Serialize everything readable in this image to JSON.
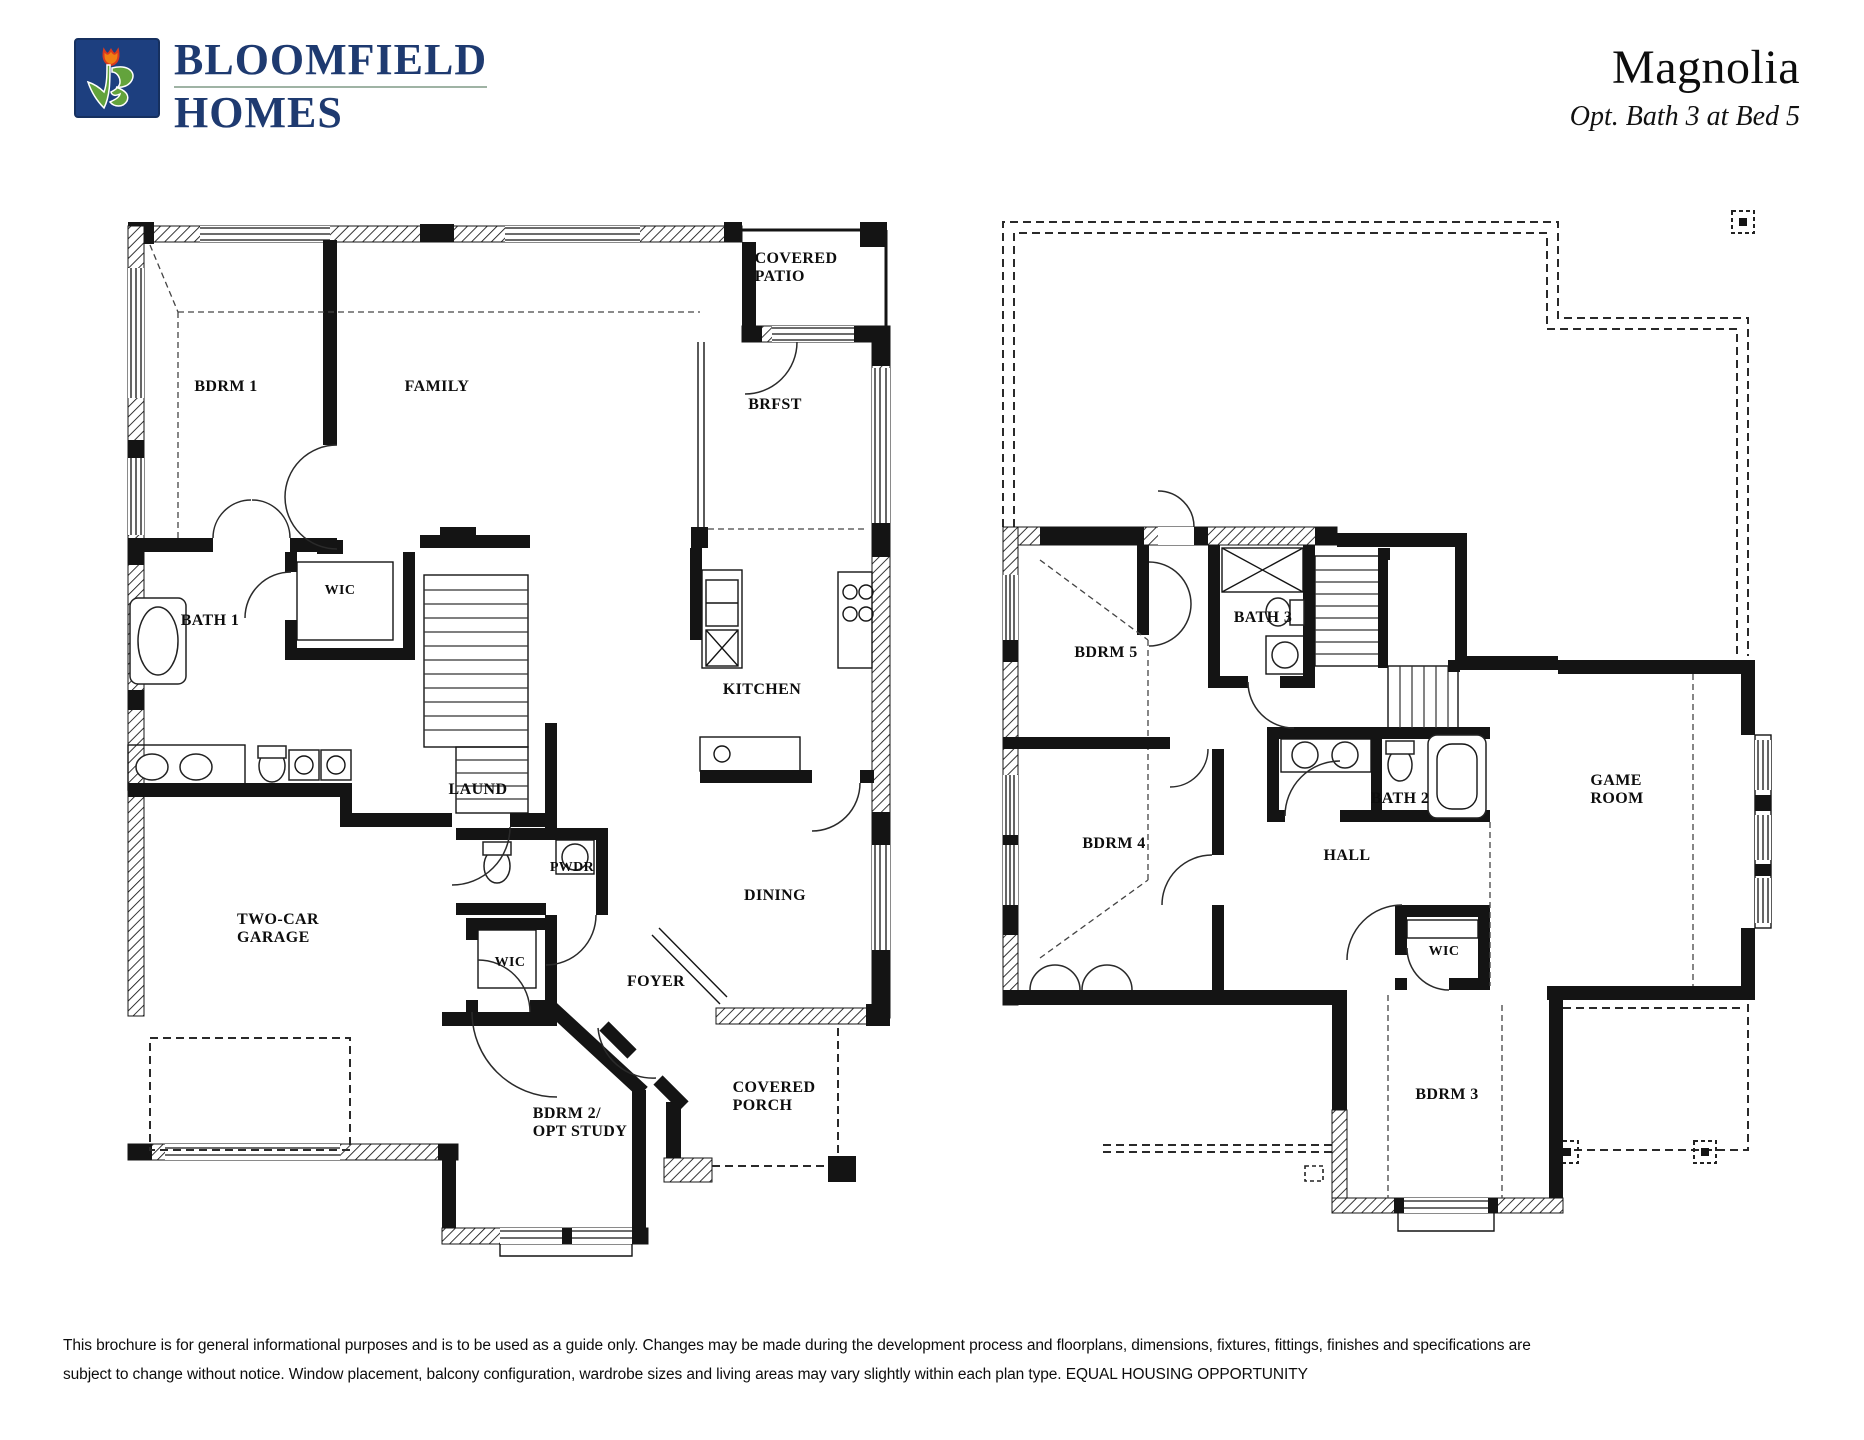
{
  "header": {
    "logo": {
      "icon": "tulip-b-monogram",
      "brand_line1": "BLOOMFIELD",
      "brand_line2": "HOMES",
      "colors": {
        "navy": "#1e3a70",
        "box_blue": "#1d3f7f",
        "leaf_green": "#63a33c",
        "tulip_orange": "#f07f13",
        "tulip_red": "#d93a1f"
      }
    },
    "plan_title": "Magnolia",
    "plan_subtitle": "Opt. Bath 3 at Bed 5"
  },
  "floor1": {
    "name": "First Floor",
    "rooms": [
      {
        "id": "covered-patio",
        "label": "COVERED\nPATIO"
      },
      {
        "id": "bdrm1",
        "label": "BDRM 1"
      },
      {
        "id": "family",
        "label": "FAMILY"
      },
      {
        "id": "brfst",
        "label": "BRFST"
      },
      {
        "id": "wic-bath1",
        "label": "WIC"
      },
      {
        "id": "bath1",
        "label": "BATH 1"
      },
      {
        "id": "kitchen",
        "label": "KITCHEN"
      },
      {
        "id": "laund",
        "label": "LAUND"
      },
      {
        "id": "pwdr",
        "label": "PWDR"
      },
      {
        "id": "dining",
        "label": "DINING"
      },
      {
        "id": "garage",
        "label": "TWO-CAR\nGARAGE"
      },
      {
        "id": "wic-foyer",
        "label": "WIC"
      },
      {
        "id": "foyer",
        "label": "FOYER"
      },
      {
        "id": "covered-porch",
        "label": "COVERED\nPORCH"
      },
      {
        "id": "bdrm2",
        "label": "BDRM 2/\nOPT STUDY"
      }
    ]
  },
  "floor2": {
    "name": "Second Floor",
    "rooms": [
      {
        "id": "bdrm5",
        "label": "BDRM 5"
      },
      {
        "id": "bath3",
        "label": "BATH 3"
      },
      {
        "id": "gameroom",
        "label": "GAME\nROOM"
      },
      {
        "id": "bath2",
        "label": "BATH 2"
      },
      {
        "id": "bdrm4",
        "label": "BDRM 4"
      },
      {
        "id": "hall",
        "label": "HALL"
      },
      {
        "id": "wic",
        "label": "WIC"
      },
      {
        "id": "bdrm3",
        "label": "BDRM 3"
      }
    ]
  },
  "footer": {
    "disclaimer_line1": "This brochure is for general informational purposes and is to be used as a guide only. Changes may be made during the development process and floorplans, dimensions, fixtures, fittings, finishes and specifications are",
    "disclaimer_line2": "subject to change without notice. Window placement, balcony configuration, wardrobe sizes and living areas may vary slightly within each plan type.  EQUAL HOUSING OPPORTUNITY"
  }
}
